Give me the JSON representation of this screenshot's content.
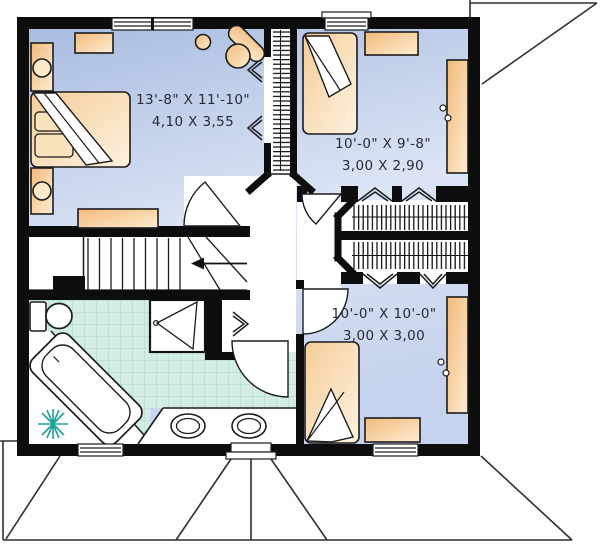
{
  "floor_plan": {
    "type": "second-floor-plan",
    "rooms": {
      "master_bedroom": {
        "dims_imperial": "13'-8\" X 11'-10\"",
        "dims_metric": "4,10 X 3,55"
      },
      "bedroom_2": {
        "dims_imperial": "10'-0\" X 9'-8\"",
        "dims_metric": "3,00 X 2,90"
      },
      "bedroom_3": {
        "dims_imperial": "10'-0\" X 10'-0\"",
        "dims_metric": "3,00 X 3,00"
      }
    },
    "symbols": {
      "stairs_direction": "arrow-left-down",
      "closet_fill": "hanging-clothes-hatch",
      "doors": "quarter-circle-swing-arcs",
      "bifold_doors": "double-chevron"
    },
    "colors": {
      "wall": "#0d0d0d",
      "room_fill": "#aebfe2",
      "room_fill_light": "#dfe7f8",
      "furniture": "#f2bb7c",
      "furniture_light": "#fdedd3",
      "bathroom_tile": "#d3ece5",
      "tile_grid": "#a8d6ca",
      "plant": "#1fa396",
      "label_text": "#2a2a33",
      "roof_line": "#2f2f2f"
    }
  }
}
